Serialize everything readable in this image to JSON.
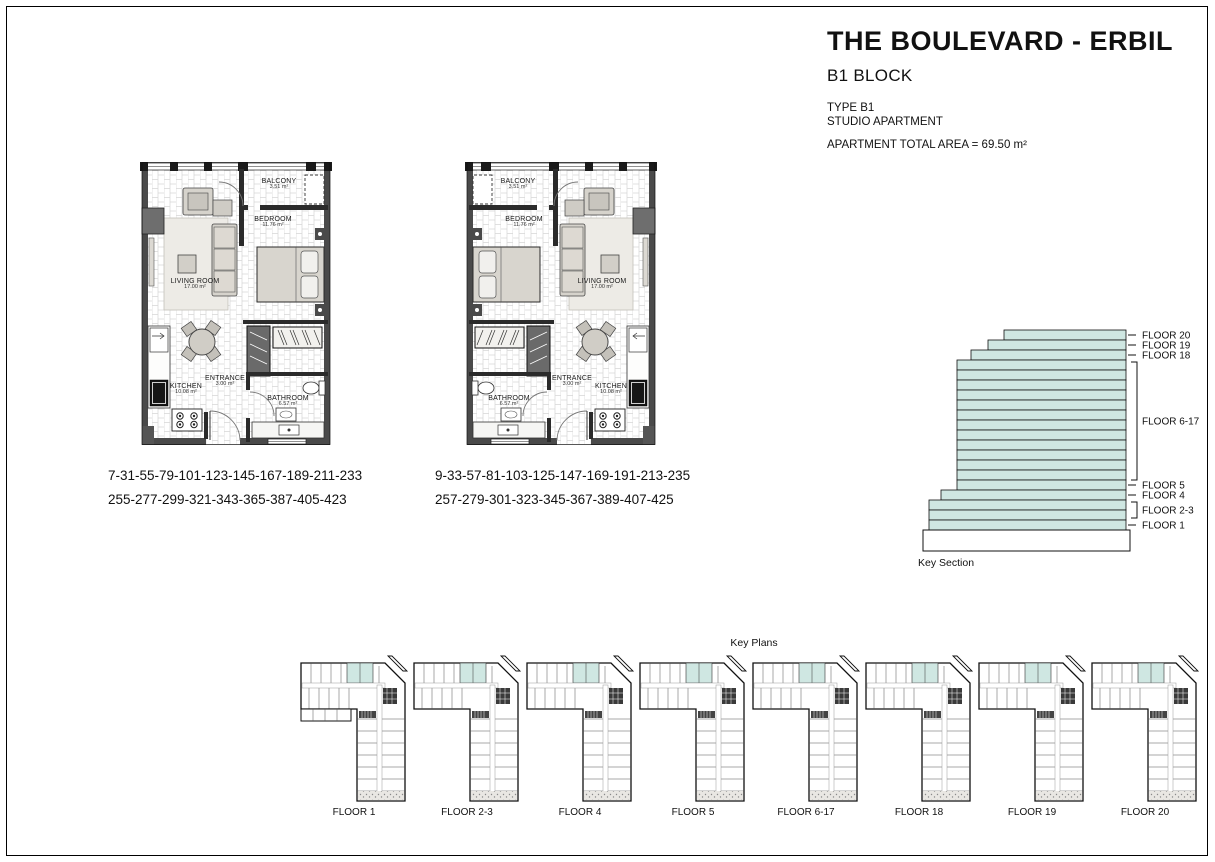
{
  "title_block": {
    "title": "THE BOULEVARD - ERBIL",
    "block_name": "B1 BLOCK",
    "type_line1": "TYPE B1",
    "type_line2": "STUDIO APARTMENT",
    "area_line": "APARTMENT TOTAL AREA = 69.50 m²"
  },
  "rooms": {
    "living_room": {
      "name": "LIVING ROOM",
      "area": "17.00 m²"
    },
    "bedroom": {
      "name": "BEDROOM",
      "area": "11.76 m²"
    },
    "balcony": {
      "name": "BALCONY",
      "area": "3.51 m²"
    },
    "kitchen": {
      "name": "KITCHEN",
      "area": "10.08 m²"
    },
    "entrance": {
      "name": "ENTRANCE",
      "area": "3.00 m²"
    },
    "bathroom": {
      "name": "BATHROOM",
      "area": "6.57 m²"
    }
  },
  "plan_left": {
    "numbers_line1": "7-31-55-79-101-123-145-167-189-211-233",
    "numbers_line2": "255-277-299-321-343-365-387-405-423"
  },
  "plan_right": {
    "numbers_line1": "9-33-57-81-103-125-147-169-191-213-235",
    "numbers_line2": "257-279-301-323-345-367-389-407-425"
  },
  "key_section": {
    "caption": "Key Section",
    "floor_20": "FLOOR 20",
    "floor_19": "FLOOR 19",
    "floor_18": "FLOOR 18",
    "floor_6_17": "FLOOR 6-17",
    "floor_5": "FLOOR 5",
    "floor_4": "FLOOR 4",
    "floor_2_3": "FLOOR 2-3",
    "floor_1": "FLOOR 1"
  },
  "key_plans": {
    "caption": "Key Plans",
    "items": [
      {
        "label": "FLOOR 1"
      },
      {
        "label": "FLOOR 2-3"
      },
      {
        "label": "FLOOR 4"
      },
      {
        "label": "FLOOR 5"
      },
      {
        "label": "FLOOR 6-17"
      },
      {
        "label": "FLOOR 18"
      },
      {
        "label": "FLOOR 19"
      },
      {
        "label": "FLOOR 20"
      }
    ]
  },
  "colors": {
    "floor_highlight": "#cfe7e2",
    "wall_dark": "#4a4a4a"
  }
}
